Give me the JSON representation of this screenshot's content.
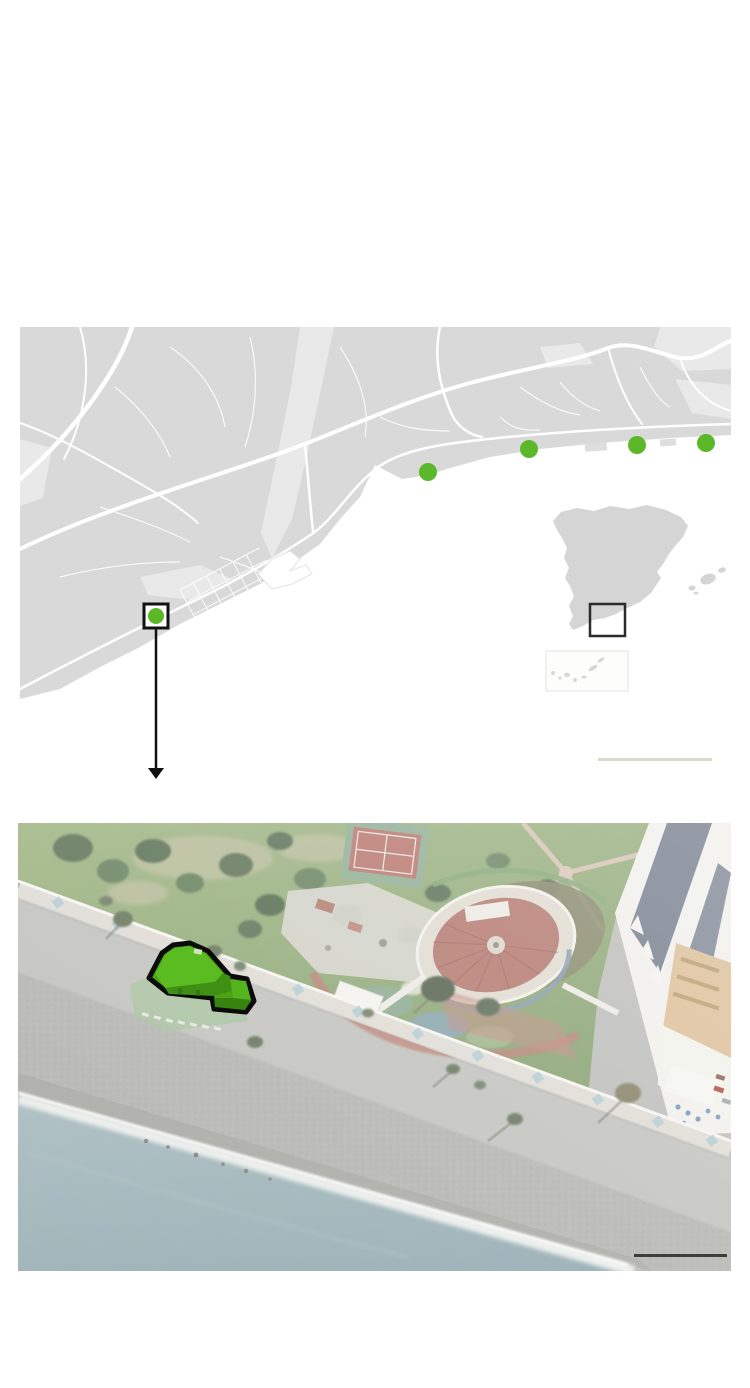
{
  "palette": {
    "accent_green": "#5cb829",
    "building_highlight_green": "#4ea315",
    "annotation_black": "#111111",
    "map_land": "#d9d9d9",
    "map_land_light": "#e9e9e9",
    "map_road": "#ffffff",
    "map_sea": "#ffffff",
    "inset_country_fill": "#d5d5d5",
    "satellite_sea": "#90a9af",
    "map_scalebar_color": "#d9d9ce",
    "satellite_scalebar_color": "#3e3e3e"
  },
  "locator_map": {
    "kind": "road-map-coastline",
    "coast_markers": [
      {
        "x": 408,
        "y": 145
      },
      {
        "x": 509,
        "y": 122
      },
      {
        "x": 617,
        "y": 118
      },
      {
        "x": 686,
        "y": 116
      }
    ],
    "marker_radius": 9,
    "highlighted_marker": {
      "x": 136,
      "y": 289,
      "radius": 8
    },
    "highlight_box": {
      "x": 124,
      "y": 277,
      "width": 24,
      "height": 24,
      "stroke_width": 3
    },
    "connector_arrow": {
      "x": 136,
      "from_y": 301,
      "to_y": 443,
      "tip_y": 452,
      "direction": "down"
    },
    "scale_bar": {
      "x": 578,
      "y": 431,
      "width": 114,
      "height": 3
    }
  },
  "inset_map": {
    "country": "Spain",
    "region_box": {
      "x": 570,
      "y": 277,
      "width": 35,
      "height": 32,
      "stroke_width": 2.5
    },
    "islands_box": {
      "x": 526,
      "y": 324,
      "width": 82,
      "height": 40
    }
  },
  "satellite_view": {
    "kind": "aerial-photo",
    "highlighted_building": {
      "fill": "#4ea315",
      "outline": "#0b0b0b",
      "outline_width": 5
    },
    "scale_bar": {
      "x": 616,
      "y": 431,
      "width": 93,
      "height": 3
    },
    "features": [
      "sea",
      "surf-line",
      "shingle-beach",
      "esplanade",
      "promenade",
      "park",
      "tennis-court",
      "round-amphitheatre",
      "theme-park-ruins",
      "apartment-buildings",
      "roof-terrace",
      "beach-bar",
      "palm-trees",
      "highlighted-green-building"
    ]
  }
}
